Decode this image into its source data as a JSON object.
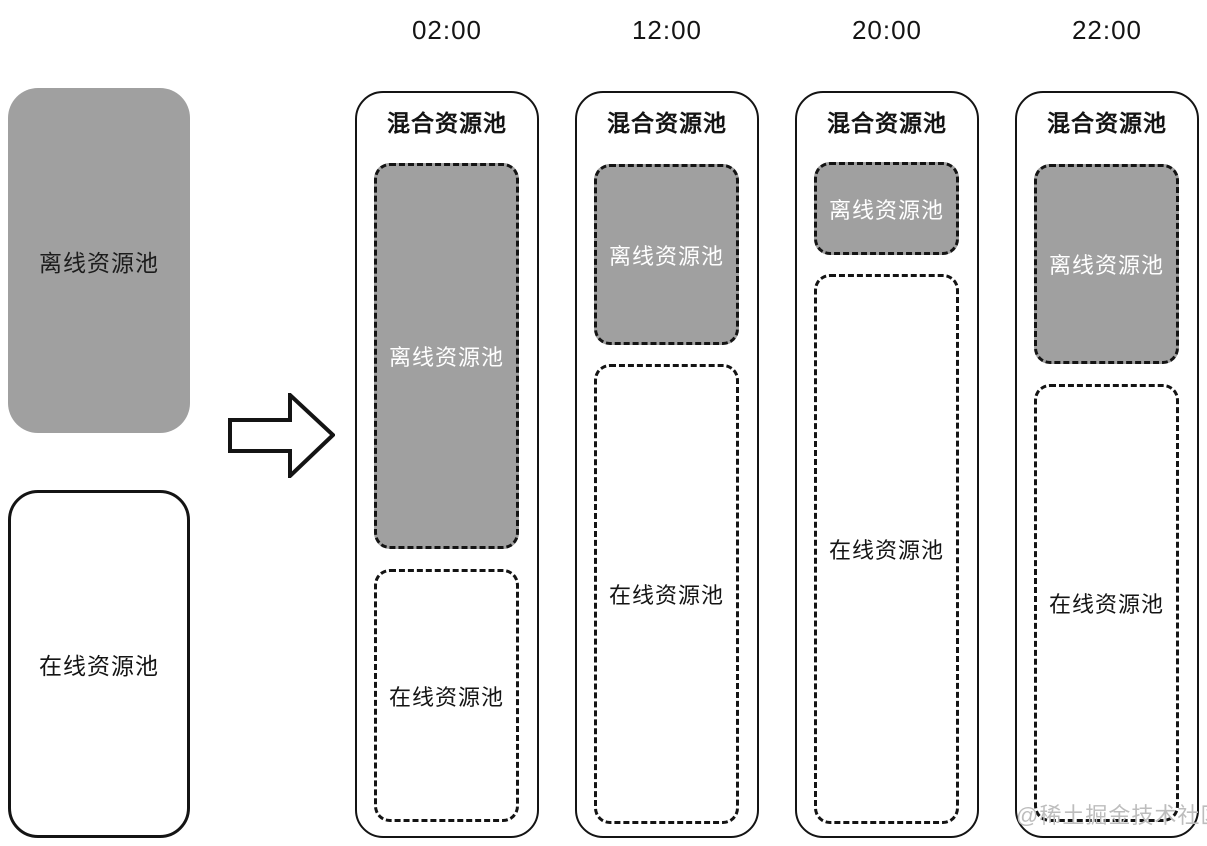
{
  "source_pools": {
    "offline": {
      "label": "离线资源池"
    },
    "online": {
      "label": "在线资源池"
    }
  },
  "timeline_columns": [
    {
      "time": "02:00",
      "title": "混合资源池",
      "offline": {
        "label": "离线资源池",
        "top": 70,
        "height": 386
      },
      "online": {
        "label": "在线资源池",
        "top": 476,
        "height": 253
      }
    },
    {
      "time": "12:00",
      "title": "混合资源池",
      "offline": {
        "label": "离线资源池",
        "top": 71,
        "height": 181
      },
      "online": {
        "label": "在线资源池",
        "top": 271,
        "height": 460
      }
    },
    {
      "time": "20:00",
      "title": "混合资源池",
      "offline": {
        "label": "离线资源池",
        "top": 69,
        "height": 93
      },
      "online": {
        "label": "在线资源池",
        "top": 181,
        "height": 550
      }
    },
    {
      "time": "22:00",
      "title": "混合资源池",
      "offline": {
        "label": "离线资源池",
        "top": 71,
        "height": 200
      },
      "online": {
        "label": "在线资源池",
        "top": 291,
        "height": 438
      }
    }
  ],
  "watermark": "@稀土掘金技术社区",
  "colors": {
    "pool_gray": "#a0a0a0",
    "line": "#141414",
    "watermark_gray": "#bdbdbd",
    "offline_text": "#ffffff",
    "online_text": "#141414"
  },
  "layout_hints": {
    "column_left_start": 355,
    "column_pitch": 220
  }
}
